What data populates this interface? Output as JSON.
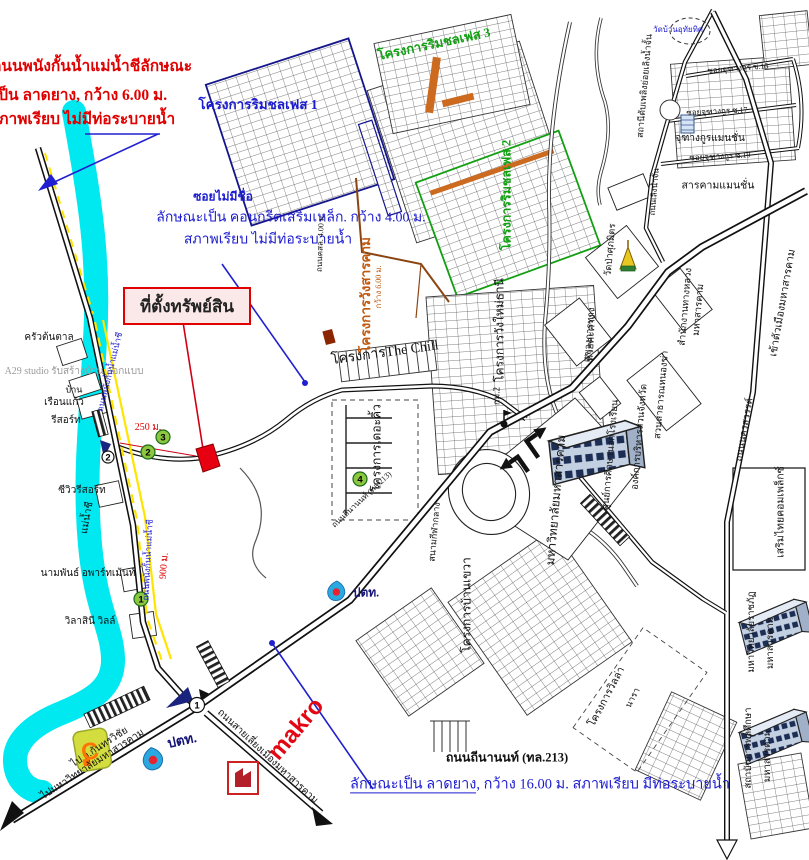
{
  "annotations": {
    "levee": {
      "line1": "ถนนพนังกั้นน้ำแม่น้ำชีลักษณะ",
      "line2": "เป็น ลาดยาง, กว้าง 6.00 ม.",
      "line3": "สภาพเรียบ ไม่มีท่อระบายน้ำ"
    },
    "soi": {
      "title": "ซอยไม่มีชื่อ",
      "line1": "ลักษณะเป็น คอนกรีตเสริมเหล็ก. กว้าง 4.00 ม.",
      "line2": "สภาพเรียบ ไม่มีท่อระบายน้ำ"
    },
    "thinanon": {
      "title": "ถนนถีนานนท์ (ทล.213)",
      "underlined": "ลักษณะเป็น ลาดยาง",
      "rest": ", กว้าง 16.00 ม. สภาพเรียบ มีท่อระบายน้ำ"
    },
    "property_label": "ที่ตั้งทรัพย์สิน"
  },
  "projects": {
    "rimchon1": "โครงการริมชลเฟส 1",
    "rimchon2": "โครงการริมชลเฟส 2",
    "rimchon3": "โครงการริมชลเฟส 3",
    "wangsarakham": "โครงการวังสารคาม",
    "wang_width": "กว้าง 6.00 ม.",
    "the_chill": "โครงการThe Chill",
    "the_kiw": "โครงการเดอะคิ้ว",
    "wangmai": "โครงการวังใหม่ธานี",
    "bankhwa": "โครงการบ้านเขวา",
    "villa": "โครงการวิลล่า",
    "villa2": "นารา"
  },
  "places": {
    "kruaton": "ครัวต้นตาล",
    "a29": "A29 studio รับสร้างบ้าน ออกแบบ",
    "baan": "บ้าน",
    "rueankaew": "เรือนแก้ว",
    "resort": "รีสอร์ท",
    "seaview": "ซีวิวรีสอร์ท",
    "maenamchi": "แม่น้ำชี",
    "nampan": "นามพันธ์ อพาร์ทเม้นท์",
    "wilasini": "วิลาสินี วิลล์",
    "firestation": "สถานีดับเพลิงย่อยเลิงน้ำจั้น",
    "wat_uthaithit": "วัดบ้านอุทัยทิศ",
    "chuthangkun": "จุฑางกูรแมนชั่น",
    "sarakham_mansion": "สารคามแมนชั่น",
    "watpa": "วัดป่าศุภมิตร",
    "kwaeng": "แขวงการทาง",
    "nongkha": "สวนสาธารณหนองข่า",
    "nfe": "ศูนย์การศึกษานอกโรงเรียน",
    "pao": "องค์การบริหารส่วนจังหวัด",
    "msu": "มหาวิทยาลัยมหาสารคาม",
    "hwy_office1": "สำนักงานทางหลวง",
    "hwy_office2": "มหาสารคาม",
    "huai": "ห้วยคะคาง",
    "sermthai": "เสริมไทยคอมเพล็กซ์",
    "rajabhat1": "มหาวิทยาลัยราชภัฏ",
    "rajabhat2": "มหาสารคาม",
    "pe1": "สถาบันการพลศึกษา",
    "pe2": "มหาสารคาม",
    "sport": "สนามกีฬากลาง"
  },
  "roads": {
    "levee": "ถนนพนังกั้นน้ำแม่น้ำชี",
    "soi_cls": "ถนนคสล. 4.00 ม.",
    "tl213": "ถนนถีนานนท์ (ทล.213)",
    "bypass": "ถนนสายเลี่ยงเมืองมหาสารคาม",
    "kanthara": "ไป อ.กันทรวิชัย",
    "tomsu": "ไปมหาวิทยาลัยมหาสารคาม",
    "city": "เข้าตัวเมืองมหาสารคาม",
    "nakhonsawan": "ถนนนครสวรรค์",
    "loengnamchan": "ถนนเลิงน้ำจั้น",
    "soi15": "ซอยจุฑางกูร ซ.15",
    "soi17": "ซอยจุฑางกูร ซ.17",
    "soi19": "ซอยจุฑางกูร ซ.19",
    "km2": "กม.2"
  },
  "distances": {
    "d250": "250 ม.",
    "d900": "900 ม."
  },
  "logos": {
    "makro": "makro",
    "ptt": "ปตท.",
    "bigc": "C"
  },
  "markers": {
    "n1": "1",
    "n2": "2",
    "n3": "3",
    "n4": "4",
    "i1": "1",
    "i2": "2"
  },
  "colors": {
    "annotation_red": "#e00000",
    "annotation_blue": "#1b1bd0",
    "project_green": "#12a012",
    "project_orange": "#c05a10",
    "river_cyan": "#00e8f0",
    "makro_red": "#e30613",
    "ptt_navy": "#151578"
  }
}
